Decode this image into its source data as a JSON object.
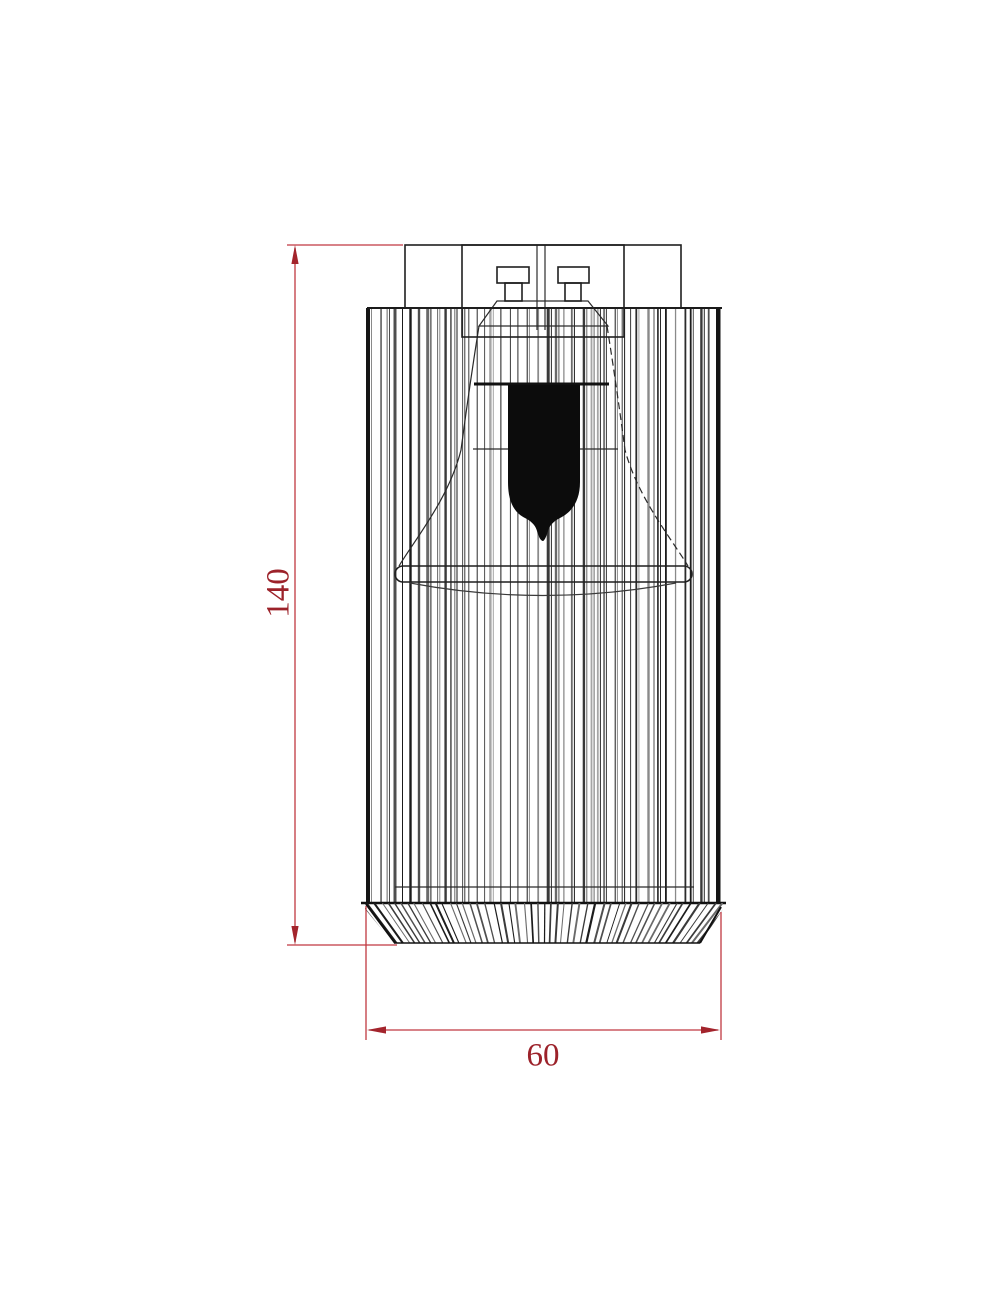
{
  "drawing": {
    "type": "technical-dimension-drawing",
    "subject": "ribbed cylindrical lamp fixture with spotlight bulb",
    "dimensions": {
      "height": {
        "value": "140"
      },
      "width": {
        "value": "60"
      }
    },
    "colors": {
      "dimension_line": "#c03840",
      "dimension_arrow": "#a3242c",
      "dimension_text": "#9c222a",
      "drawing_line": "#1a1a1a",
      "background": "#ffffff"
    }
  }
}
